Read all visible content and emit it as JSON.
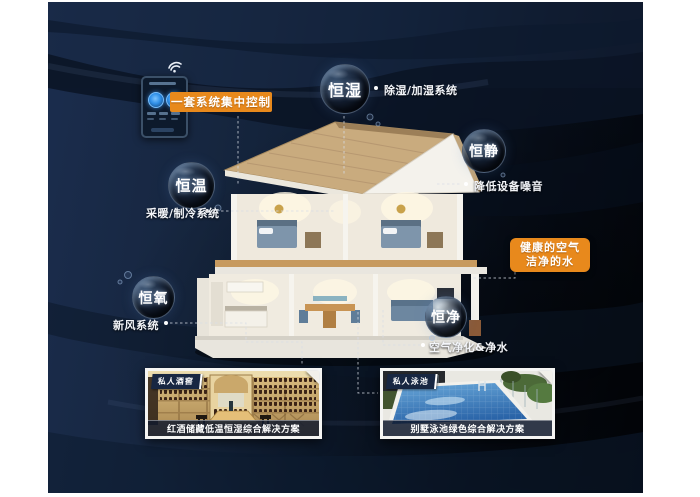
{
  "scene": {
    "control_label": "一套系统集中控制",
    "highlight": {
      "line1": "健康的空气",
      "line2": "洁净的水"
    },
    "bubbles": {
      "humidity": {
        "label": "恒湿",
        "note": "除湿/加湿系统"
      },
      "quiet": {
        "label": "恒静",
        "note": "降低设备噪音"
      },
      "temperature": {
        "label": "恒温",
        "note": "采暖/制冷系统"
      },
      "oxygen": {
        "label": "恒氧",
        "note": "新风系统"
      },
      "purity": {
        "label": "恒净",
        "note": "空气净化&净水"
      }
    },
    "cards": {
      "wine": {
        "tag": "私人酒窖",
        "caption": "红酒储藏低温恒湿综合解决方案"
      },
      "pool": {
        "tag": "私人泳池",
        "caption": "别墅泳池绿色综合解决方案"
      }
    },
    "colors": {
      "accent": "#e8891c",
      "bg_navy": "#16263f",
      "bg_black": "#03060c"
    }
  }
}
